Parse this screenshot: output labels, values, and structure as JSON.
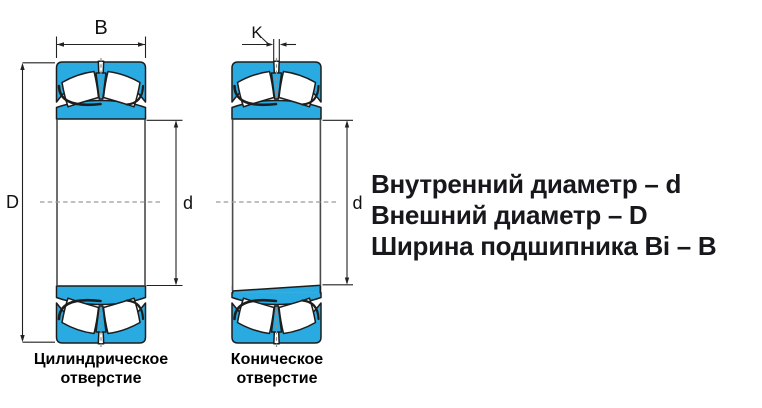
{
  "diagram": {
    "dimension_labels": {
      "width": "B",
      "gap": "K",
      "outer_diameter": "D",
      "bore_left": "d",
      "bore_right": "d"
    },
    "captions": {
      "cylindrical": {
        "line1": "Цилиндрическое",
        "line2": "отверстие"
      },
      "tapered": {
        "line1": "Коническое",
        "line2": "отверстие"
      }
    }
  },
  "legend": {
    "lines": [
      "Внутренний диаметр – d",
      "Внешний диаметр – D",
      "Ширина подшипника Bi – B"
    ]
  },
  "colors": {
    "bearing_fill": "#29ABE2",
    "outline": "#1D1D1D",
    "dimension_line": "#222222",
    "centerline": "#9A9A9A",
    "legend_text": "#17171C"
  }
}
